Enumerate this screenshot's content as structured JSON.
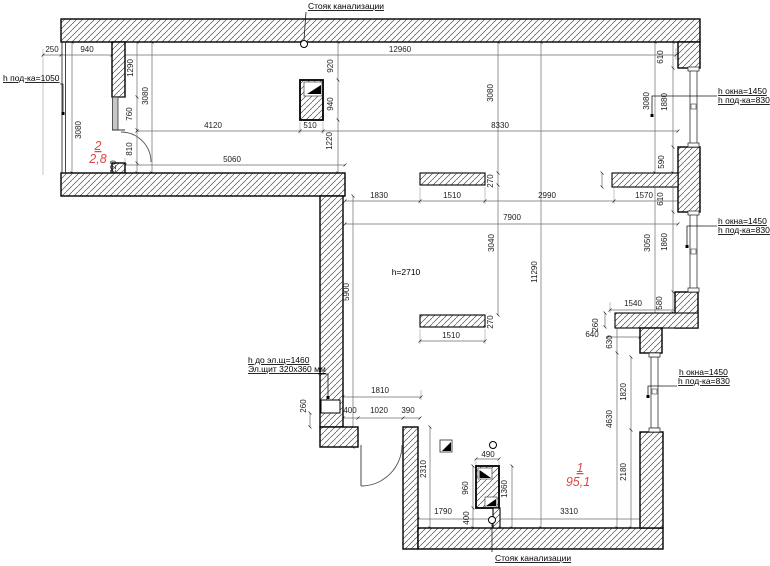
{
  "drawing_type": "apartment floor plan (measurement drawing)",
  "colors": {
    "background": "#ffffff",
    "wall_outline": "#000000",
    "hatch_line": "#4a4a4a",
    "dimension_text": "#1c1c1c",
    "room_label": "#e04545",
    "window_fill": "#c6c6c6"
  },
  "legend": {
    "rooms": [
      {
        "number": "2",
        "area_m2": "2,8"
      },
      {
        "number": "1",
        "area_m2": "95,1"
      }
    ],
    "ceiling_height_note": "h=2710",
    "sewer_riser_label": "Стояк канализации",
    "electrical_panel": {
      "label": "ЭЩ",
      "size_note": "Эл.щит 320x360 мм",
      "height_note": "h до эл.щ=1460"
    },
    "window_notes": [
      "h окна=1450",
      "h под-ка=830",
      "h под-ка=1050"
    ]
  },
  "labels": [
    {
      "t": "250",
      "x": 52,
      "y": 52,
      "k": "d"
    },
    {
      "t": "940",
      "x": 87,
      "y": 52,
      "k": "d"
    },
    {
      "t": "12960",
      "x": 400,
      "y": 52,
      "k": "d"
    },
    {
      "t": "1290",
      "x": 133,
      "y": 68,
      "k": "d",
      "v": 1
    },
    {
      "t": "3080",
      "x": 81,
      "y": 130,
      "k": "d",
      "v": 1
    },
    {
      "t": "760",
      "x": 132,
      "y": 114,
      "k": "d",
      "v": 1
    },
    {
      "t": "810",
      "x": 132,
      "y": 149,
      "k": "d",
      "v": 1
    },
    {
      "t": "220",
      "x": 116,
      "y": 167,
      "k": "d",
      "v": 1
    },
    {
      "t": "3080",
      "x": 148,
      "y": 96,
      "k": "d",
      "v": 1
    },
    {
      "t": "920",
      "x": 333,
      "y": 66,
      "k": "d",
      "v": 1
    },
    {
      "t": "940",
      "x": 333,
      "y": 104,
      "k": "d",
      "v": 1
    },
    {
      "t": "510",
      "x": 310,
      "y": 128,
      "k": "d"
    },
    {
      "t": "1220",
      "x": 332,
      "y": 141,
      "k": "d",
      "v": 1
    },
    {
      "t": "4120",
      "x": 213,
      "y": 128,
      "k": "d"
    },
    {
      "t": "8330",
      "x": 500,
      "y": 128,
      "k": "d"
    },
    {
      "t": "3080",
      "x": 493,
      "y": 93,
      "k": "d",
      "v": 1
    },
    {
      "t": "3080",
      "x": 649,
      "y": 101,
      "k": "d",
      "v": 1
    },
    {
      "t": "1880",
      "x": 667,
      "y": 102,
      "k": "d",
      "v": 1
    },
    {
      "t": "610",
      "x": 663,
      "y": 57,
      "k": "d",
      "v": 1
    },
    {
      "t": "5060",
      "x": 232,
      "y": 162,
      "k": "d"
    },
    {
      "t": "1830",
      "x": 379,
      "y": 198,
      "k": "d"
    },
    {
      "t": "1510",
      "x": 452,
      "y": 198,
      "k": "d"
    },
    {
      "t": "270",
      "x": 493,
      "y": 181,
      "k": "d",
      "v": 1
    },
    {
      "t": "2990",
      "x": 547,
      "y": 198,
      "k": "d"
    },
    {
      "t": "1570",
      "x": 644,
      "y": 198,
      "k": "d"
    },
    {
      "t": "610",
      "x": 663,
      "y": 199,
      "k": "d",
      "v": 1
    },
    {
      "t": "590",
      "x": 664,
      "y": 162,
      "k": "d",
      "v": 1
    },
    {
      "t": "7900",
      "x": 512,
      "y": 220,
      "k": "d"
    },
    {
      "t": "3040",
      "x": 494,
      "y": 243,
      "k": "d",
      "v": 1
    },
    {
      "t": "11290",
      "x": 537,
      "y": 272,
      "k": "d",
      "v": 1
    },
    {
      "t": "5900",
      "x": 349,
      "y": 292,
      "k": "d",
      "v": 1
    },
    {
      "t": "3050",
      "x": 650,
      "y": 243,
      "k": "d",
      "v": 1
    },
    {
      "t": "1860",
      "x": 667,
      "y": 242,
      "k": "d",
      "v": 1
    },
    {
      "t": "1510",
      "x": 451,
      "y": 338,
      "k": "d"
    },
    {
      "t": "270",
      "x": 493,
      "y": 322,
      "k": "d",
      "v": 1
    },
    {
      "t": "1540",
      "x": 633,
      "y": 306,
      "k": "d"
    },
    {
      "t": "580",
      "x": 662,
      "y": 303,
      "k": "d",
      "v": 1
    },
    {
      "t": "260",
      "x": 598,
      "y": 325,
      "k": "d",
      "v": 1
    },
    {
      "t": "640",
      "x": 592,
      "y": 337,
      "k": "d"
    },
    {
      "t": "630",
      "x": 612,
      "y": 342,
      "k": "d",
      "v": 1
    },
    {
      "t": "1820",
      "x": 626,
      "y": 392,
      "k": "d",
      "v": 1
    },
    {
      "t": "4630",
      "x": 612,
      "y": 419,
      "k": "d",
      "v": 1
    },
    {
      "t": "2180",
      "x": 626,
      "y": 472,
      "k": "d",
      "v": 1
    },
    {
      "t": "1810",
      "x": 380,
      "y": 393,
      "k": "d"
    },
    {
      "t": "260",
      "x": 306,
      "y": 406,
      "k": "d",
      "v": 1
    },
    {
      "t": "400",
      "x": 350,
      "y": 413,
      "k": "d"
    },
    {
      "t": "1020",
      "x": 379,
      "y": 413,
      "k": "d"
    },
    {
      "t": "390",
      "x": 408,
      "y": 413,
      "k": "d"
    },
    {
      "t": "2310",
      "x": 426,
      "y": 469,
      "k": "d",
      "v": 1
    },
    {
      "t": "490",
      "x": 488,
      "y": 457,
      "k": "d"
    },
    {
      "t": "960",
      "x": 468,
      "y": 488,
      "k": "d",
      "v": 1
    },
    {
      "t": "1360",
      "x": 507,
      "y": 489,
      "k": "d",
      "v": 1
    },
    {
      "t": "1790",
      "x": 443,
      "y": 514,
      "k": "d"
    },
    {
      "t": "400",
      "x": 469,
      "y": 518,
      "k": "d",
      "v": 1
    },
    {
      "t": "3310",
      "x": 569,
      "y": 514,
      "k": "d"
    },
    {
      "t": "Стояк канализации",
      "x": 346,
      "y": 9,
      "k": "a",
      "u": 1
    },
    {
      "t": "Стояк канализации",
      "x": 495,
      "y": 561,
      "k": "a",
      "u": 1,
      "s": 1
    },
    {
      "t": "h под-ка=1050",
      "x": 3,
      "y": 81,
      "k": "a",
      "u": 1,
      "s": 1
    },
    {
      "t": "h окна=1450",
      "x": 718,
      "y": 94,
      "k": "a",
      "u": 1,
      "s": 1
    },
    {
      "t": "h под-ка=830",
      "x": 718,
      "y": 103,
      "k": "a",
      "u": 1,
      "s": 1
    },
    {
      "t": "h окна=1450",
      "x": 718,
      "y": 224,
      "k": "a",
      "u": 1,
      "s": 1
    },
    {
      "t": "h под-ка=830",
      "x": 718,
      "y": 233,
      "k": "a",
      "u": 1,
      "s": 1
    },
    {
      "t": "h окна=1450",
      "x": 679,
      "y": 375,
      "k": "a",
      "u": 1,
      "s": 1
    },
    {
      "t": "h под-ка=830",
      "x": 678,
      "y": 384,
      "k": "a",
      "u": 1,
      "s": 1
    },
    {
      "t": "h до эл.щ=1460",
      "x": 248,
      "y": 363,
      "k": "a",
      "u": 1,
      "s": 1
    },
    {
      "t": "Эл.щит 320x360 мм",
      "x": 248,
      "y": 372,
      "k": "a",
      "u": 1,
      "s": 1
    },
    {
      "t": "h=2710",
      "x": 406,
      "y": 275,
      "k": "a"
    },
    {
      "t": "2",
      "x": 98,
      "y": 150,
      "k": "r",
      "u": 1
    },
    {
      "t": "2,8",
      "x": 98,
      "y": 163,
      "k": "r"
    },
    {
      "t": "1",
      "x": 580,
      "y": 472,
      "k": "r",
      "u": 1
    },
    {
      "t": "95,1",
      "x": 578,
      "y": 486,
      "k": "r"
    }
  ]
}
